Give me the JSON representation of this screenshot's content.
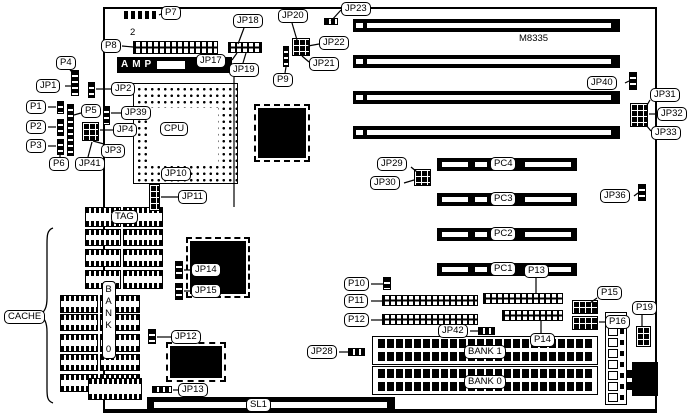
{
  "figure": {
    "model": "M8335"
  },
  "texts": [
    {
      "id": "cpu",
      "text": "CPU",
      "x": 160,
      "y": 122,
      "style": "box"
    },
    {
      "id": "tag",
      "text": "TAG",
      "x": 111,
      "y": 210,
      "style": "box"
    },
    {
      "id": "cache",
      "text": "CACHE",
      "x": 4,
      "y": 310,
      "style": "box"
    },
    {
      "id": "sl1",
      "text": "SL1",
      "x": 246,
      "y": 398,
      "style": "box"
    },
    {
      "id": "bank0-vertical",
      "text": "BANK 0",
      "x": 102,
      "y": 281,
      "style": "vert"
    },
    {
      "id": "model",
      "text": "M8335",
      "x": 519,
      "y": 33,
      "style": "plain"
    },
    {
      "id": "pin2",
      "text": "2",
      "x": 130,
      "y": 27,
      "style": "plain"
    },
    {
      "id": "amp",
      "text": "AMP",
      "x": 121,
      "y": 59,
      "style": "amp"
    }
  ],
  "callouts": [
    {
      "id": "p7",
      "text": "P7",
      "x": 161,
      "y": 6,
      "leader": [
        161,
        14,
        159,
        15
      ]
    },
    {
      "id": "jp18",
      "text": "JP18",
      "x": 233,
      "y": 14,
      "leader": [
        244,
        28,
        238,
        44
      ]
    },
    {
      "id": "jp20",
      "text": "JP20",
      "x": 278,
      "y": 9,
      "leader": [
        292,
        23,
        297,
        40
      ]
    },
    {
      "id": "jp23",
      "text": "JP23",
      "x": 341,
      "y": 2,
      "leader": [
        341,
        10,
        331,
        21
      ]
    },
    {
      "id": "p8",
      "text": "P8",
      "x": 101,
      "y": 39,
      "leader": [
        122,
        46,
        133,
        47
      ]
    },
    {
      "id": "jp22",
      "text": "JP22",
      "x": 319,
      "y": 36,
      "leader": [
        319,
        44,
        308,
        46
      ]
    },
    {
      "id": "jp17",
      "text": "JP17",
      "x": 196,
      "y": 54,
      "leader": [
        232,
        60,
        237,
        53
      ]
    },
    {
      "id": "jp19",
      "text": "JP19",
      "x": 229,
      "y": 63,
      "leader": [
        243,
        63,
        246,
        53
      ],
      "leader2": [
        234,
        77,
        234,
        207
      ]
    },
    {
      "id": "jp21",
      "text": "JP21",
      "x": 309,
      "y": 57,
      "leader": [
        309,
        62,
        302,
        56
      ]
    },
    {
      "id": "p9",
      "text": "P9",
      "x": 273,
      "y": 73,
      "leader": [
        285,
        73,
        286,
        67
      ]
    },
    {
      "id": "jp40",
      "text": "JP40",
      "x": 587,
      "y": 76,
      "leader": [
        625,
        83,
        629,
        81
      ]
    },
    {
      "id": "jp31",
      "text": "JP31",
      "x": 650,
      "y": 88,
      "leader": [
        650,
        100,
        646,
        107
      ]
    },
    {
      "id": "jp32",
      "text": "JP32",
      "x": 657,
      "y": 107,
      "leader": [
        656,
        114,
        649,
        114
      ]
    },
    {
      "id": "jp33",
      "text": "JP33",
      "x": 651,
      "y": 126,
      "leader": [
        651,
        131,
        646,
        125
      ]
    },
    {
      "id": "p4",
      "text": "P4",
      "x": 56,
      "y": 56,
      "leader": [
        70,
        70,
        74,
        74
      ]
    },
    {
      "id": "jp1",
      "text": "JP1",
      "x": 36,
      "y": 79,
      "leader": [
        65,
        86,
        71,
        86
      ]
    },
    {
      "id": "jp2",
      "text": "JP2",
      "x": 111,
      "y": 82,
      "leader": [
        111,
        89,
        96,
        89
      ]
    },
    {
      "id": "p1",
      "text": "P1",
      "x": 26,
      "y": 100,
      "leader": [
        48,
        107,
        56,
        107
      ]
    },
    {
      "id": "p5",
      "text": "P5",
      "x": 81,
      "y": 104,
      "leader": [
        81,
        113,
        74,
        115
      ]
    },
    {
      "id": "jp39",
      "text": "JP39",
      "x": 121,
      "y": 106,
      "leader": [
        121,
        113,
        111,
        113
      ]
    },
    {
      "id": "p2",
      "text": "P2",
      "x": 26,
      "y": 120,
      "leader": [
        48,
        127,
        56,
        127
      ]
    },
    {
      "id": "jp4",
      "text": "JP4",
      "x": 113,
      "y": 123,
      "leader": [
        113,
        130,
        100,
        130
      ]
    },
    {
      "id": "p3",
      "text": "P3",
      "x": 26,
      "y": 139,
      "leader": [
        48,
        146,
        56,
        146
      ]
    },
    {
      "id": "jp3",
      "text": "JP3",
      "x": 101,
      "y": 144,
      "leader": [
        104,
        144,
        93,
        141
      ]
    },
    {
      "id": "p6",
      "text": "P6",
      "x": 49,
      "y": 157,
      "leader": [
        60,
        157,
        60,
        152
      ]
    },
    {
      "id": "jp41",
      "text": "JP41",
      "x": 75,
      "y": 157,
      "leader": [
        88,
        157,
        92,
        142
      ]
    },
    {
      "id": "jp10",
      "text": "JP10",
      "x": 161,
      "y": 167,
      "leader": []
    },
    {
      "id": "jp11",
      "text": "JP11",
      "x": 178,
      "y": 190,
      "leader": [
        178,
        197,
        161,
        197
      ]
    },
    {
      "id": "jp29",
      "text": "JP29",
      "x": 377,
      "y": 157,
      "leader": [
        411,
        167,
        417,
        172
      ]
    },
    {
      "id": "jp30",
      "text": "JP30",
      "x": 370,
      "y": 176,
      "leader": [
        404,
        183,
        414,
        180
      ]
    },
    {
      "id": "jp36",
      "text": "JP36",
      "x": 600,
      "y": 189,
      "leader": [
        634,
        196,
        638,
        193
      ]
    },
    {
      "id": "p10",
      "text": "P10",
      "x": 344,
      "y": 277,
      "leader": [
        371,
        284,
        383,
        284
      ]
    },
    {
      "id": "p11",
      "text": "P11",
      "x": 344,
      "y": 294,
      "leader": [
        371,
        301,
        382,
        301
      ]
    },
    {
      "id": "p12",
      "text": "P12",
      "x": 344,
      "y": 313,
      "leader": [
        371,
        320,
        382,
        320
      ]
    },
    {
      "id": "jp42",
      "text": "JP42",
      "x": 438,
      "y": 324,
      "leader": [
        470,
        331,
        478,
        331
      ]
    },
    {
      "id": "p13",
      "text": "P13",
      "x": 524,
      "y": 264,
      "leader": [
        536,
        278,
        536,
        293
      ]
    },
    {
      "id": "p14",
      "text": "P14",
      "x": 530,
      "y": 333,
      "leader": [
        541,
        333,
        541,
        321
      ]
    },
    {
      "id": "p15",
      "text": "P15",
      "x": 597,
      "y": 286,
      "leader": [
        597,
        298,
        590,
        303
      ]
    },
    {
      "id": "p16",
      "text": "P16",
      "x": 605,
      "y": 315,
      "leader": [
        605,
        322,
        599,
        322
      ]
    },
    {
      "id": "p19",
      "text": "P19",
      "x": 632,
      "y": 301,
      "leader": [
        642,
        315,
        642,
        326
      ]
    },
    {
      "id": "jp28",
      "text": "JP28",
      "x": 307,
      "y": 345,
      "leader": [
        339,
        352,
        348,
        352
      ]
    },
    {
      "id": "jp12",
      "text": "JP12",
      "x": 171,
      "y": 330,
      "leader": [
        171,
        337,
        157,
        337
      ]
    },
    {
      "id": "jp13",
      "text": "JP13",
      "x": 178,
      "y": 383,
      "leader": [
        178,
        390,
        173,
        390
      ]
    },
    {
      "id": "jp14",
      "text": "JP14",
      "x": 191,
      "y": 263,
      "leader": [
        191,
        270,
        184,
        270
      ]
    },
    {
      "id": "jp15",
      "text": "JP15",
      "x": 191,
      "y": 284,
      "leader": [
        191,
        291,
        184,
        291
      ]
    }
  ],
  "board_outline": {
    "x": 103,
    "y": 7,
    "w": 554,
    "h": 406
  },
  "cpu_socket": {
    "x": 133,
    "y": 83,
    "w": 105,
    "h": 101,
    "inner": {
      "x": 150,
      "y": 108,
      "w": 68,
      "h": 54
    }
  },
  "isa_slots": [
    {
      "x": 353,
      "y": 19,
      "w": 267,
      "h": 13
    },
    {
      "x": 353,
      "y": 55,
      "w": 267,
      "h": 13
    },
    {
      "x": 353,
      "y": 91,
      "w": 267,
      "h": 13
    },
    {
      "x": 353,
      "y": 126,
      "w": 267,
      "h": 13
    }
  ],
  "pci_slots": [
    {
      "label": "PC4",
      "x": 437,
      "y": 158
    },
    {
      "label": "PC3",
      "x": 437,
      "y": 193
    },
    {
      "label": "PC2",
      "x": 437,
      "y": 228
    },
    {
      "label": "PC1",
      "x": 437,
      "y": 263
    }
  ],
  "simm_banks": [
    {
      "label": "BANK 1",
      "x": 372,
      "y": 336
    },
    {
      "label": "BANK 0",
      "x": 372,
      "y": 366
    }
  ],
  "cache_chips": [
    {
      "x": 85,
      "y": 207,
      "w": 36,
      "h": 20
    },
    {
      "x": 123,
      "y": 207,
      "w": 40,
      "h": 20
    },
    {
      "x": 85,
      "y": 229,
      "w": 36,
      "h": 17
    },
    {
      "x": 123,
      "y": 229,
      "w": 40,
      "h": 17
    },
    {
      "x": 85,
      "y": 249,
      "w": 36,
      "h": 18
    },
    {
      "x": 123,
      "y": 249,
      "w": 40,
      "h": 18
    },
    {
      "x": 85,
      "y": 270,
      "w": 36,
      "h": 19
    },
    {
      "x": 123,
      "y": 270,
      "w": 40,
      "h": 19
    },
    {
      "x": 60,
      "y": 295,
      "w": 38,
      "h": 18
    },
    {
      "x": 100,
      "y": 295,
      "w": 40,
      "h": 18
    },
    {
      "x": 60,
      "y": 314,
      "w": 38,
      "h": 17
    },
    {
      "x": 100,
      "y": 314,
      "w": 40,
      "h": 17
    },
    {
      "x": 60,
      "y": 334,
      "w": 38,
      "h": 18
    },
    {
      "x": 100,
      "y": 334,
      "w": 40,
      "h": 18
    },
    {
      "x": 60,
      "y": 354,
      "w": 38,
      "h": 17
    },
    {
      "x": 100,
      "y": 354,
      "w": 40,
      "h": 17
    },
    {
      "x": 60,
      "y": 374,
      "w": 38,
      "h": 18
    },
    {
      "x": 100,
      "y": 374,
      "w": 40,
      "h": 18
    }
  ],
  "qfp_chips": [
    {
      "x": 258,
      "y": 108,
      "w": 48,
      "h": 50
    },
    {
      "x": 190,
      "y": 241,
      "w": 56,
      "h": 53
    },
    {
      "x": 170,
      "y": 346,
      "w": 52,
      "h": 32
    }
  ],
  "dip_chips": [
    {
      "x": 88,
      "y": 378,
      "w": 54,
      "h": 22
    }
  ],
  "jumpers": [
    {
      "t": "d",
      "x": 124,
      "y": 11,
      "w": 35,
      "h": 8
    },
    {
      "t": "l",
      "x": 133,
      "y": 41,
      "w": 85,
      "h": 13
    },
    {
      "t": "l",
      "x": 228,
      "y": 42,
      "w": 34,
      "h": 11
    },
    {
      "t": "g",
      "x": 292,
      "y": 38,
      "w": 18,
      "h": 18
    },
    {
      "t": "v",
      "x": 283,
      "y": 46,
      "w": 6,
      "h": 21
    },
    {
      "t": "h",
      "x": 324,
      "y": 18,
      "w": 14,
      "h": 7
    },
    {
      "t": "v",
      "x": 71,
      "y": 70,
      "w": 8,
      "h": 26
    },
    {
      "t": "v",
      "x": 88,
      "y": 82,
      "w": 7,
      "h": 16
    },
    {
      "t": "v",
      "x": 57,
      "y": 101,
      "w": 7,
      "h": 13
    },
    {
      "t": "v",
      "x": 67,
      "y": 104,
      "w": 7,
      "h": 52
    },
    {
      "t": "v",
      "x": 103,
      "y": 106,
      "w": 7,
      "h": 19
    },
    {
      "t": "v",
      "x": 57,
      "y": 119,
      "w": 7,
      "h": 17
    },
    {
      "t": "g",
      "x": 82,
      "y": 122,
      "w": 17,
      "h": 19
    },
    {
      "t": "v",
      "x": 57,
      "y": 139,
      "w": 7,
      "h": 16
    },
    {
      "t": "g",
      "x": 149,
      "y": 184,
      "w": 11,
      "h": 27
    },
    {
      "t": "v",
      "x": 629,
      "y": 72,
      "w": 8,
      "h": 18
    },
    {
      "t": "g",
      "x": 630,
      "y": 103,
      "w": 18,
      "h": 24
    },
    {
      "t": "v",
      "x": 638,
      "y": 184,
      "w": 8,
      "h": 17
    },
    {
      "t": "g",
      "x": 414,
      "y": 169,
      "w": 17,
      "h": 17
    },
    {
      "t": "v",
      "x": 175,
      "y": 261,
      "w": 8,
      "h": 18
    },
    {
      "t": "v",
      "x": 175,
      "y": 283,
      "w": 8,
      "h": 17
    },
    {
      "t": "v",
      "x": 148,
      "y": 329,
      "w": 8,
      "h": 15
    },
    {
      "t": "v",
      "x": 383,
      "y": 277,
      "w": 8,
      "h": 13
    },
    {
      "t": "l",
      "x": 382,
      "y": 295,
      "w": 96,
      "h": 11
    },
    {
      "t": "l",
      "x": 382,
      "y": 314,
      "w": 96,
      "h": 11
    },
    {
      "t": "l",
      "x": 483,
      "y": 293,
      "w": 80,
      "h": 11
    },
    {
      "t": "l",
      "x": 502,
      "y": 310,
      "w": 61,
      "h": 11
    },
    {
      "t": "h",
      "x": 478,
      "y": 327,
      "w": 17,
      "h": 8
    },
    {
      "t": "h",
      "x": 348,
      "y": 348,
      "w": 17,
      "h": 8
    },
    {
      "t": "h",
      "x": 152,
      "y": 386,
      "w": 20,
      "h": 7
    },
    {
      "t": "g",
      "x": 572,
      "y": 300,
      "w": 26,
      "h": 14
    },
    {
      "t": "g",
      "x": 572,
      "y": 316,
      "w": 26,
      "h": 14
    },
    {
      "t": "g",
      "x": 636,
      "y": 326,
      "w": 15,
      "h": 21
    }
  ],
  "amp_connector": {
    "x": 117,
    "y": 57,
    "w": 115,
    "h": 16
  },
  "sl1_slot": {
    "x": 147,
    "y": 397,
    "w": 248,
    "h": 15
  },
  "power_connector": {
    "x": 605,
    "y": 312,
    "w": 22,
    "h": 93
  },
  "keyboard_connector": {
    "x": 632,
    "y": 362,
    "w": 26,
    "h": 34
  }
}
